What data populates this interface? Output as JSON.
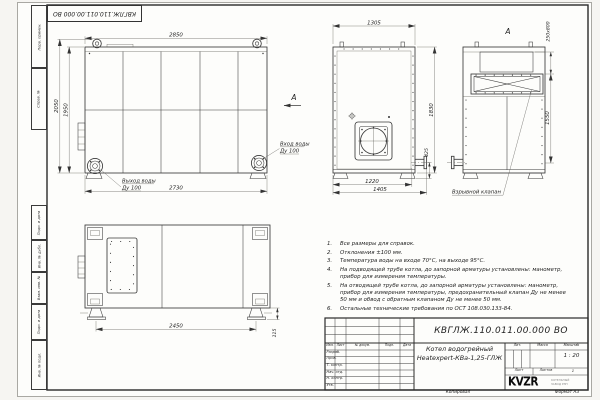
{
  "sheet": {
    "stamp_top": "КВГЛЖ.110.011.00.000 ВО",
    "side_labels": [
      "Перв. примен.",
      "Справ. №",
      "Подп. и дата",
      "Инв. № дубл.",
      "Взам. инв. №",
      "Подп. и дата",
      "Инв. № подл."
    ],
    "footer": {
      "copied": "Копировал",
      "format": "Формат А3"
    },
    "colors": {
      "line": "#3a3a3a",
      "paper": "#fdfdfb"
    }
  },
  "views": {
    "front": {
      "dim_width_top": "2850",
      "dim_height_outer": "2050",
      "dim_height_inner": "1950",
      "dim_width_bottom": "2730",
      "outlet_label": "Выход воды",
      "outlet_size": "Ду 100",
      "inlet_label": "Вход воды",
      "inlet_size": "Ду 100",
      "section_arrow": "А"
    },
    "side": {
      "dim_width_top": "1305",
      "dim_height": "1830",
      "dim_width_bottom_inner": "1220",
      "dim_width_bottom_outer": "1405",
      "dim_pipe": "425"
    },
    "view_a": {
      "label": "А",
      "dim_valve": "250x800",
      "dim_height": "1550",
      "callout": "Взрывной клапан"
    },
    "plan": {
      "dim_width": "2450",
      "dim_foot": "115"
    }
  },
  "notes": [
    {
      "num": "1.",
      "text": "Все размеры для справок."
    },
    {
      "num": "2.",
      "text": "Отклонения ±100 мм."
    },
    {
      "num": "3.",
      "text": "Температура воды на входе 70°С, на выходе 95°С."
    },
    {
      "num": "4.",
      "text": "На подводящей трубе котла, до запорной арматуры установлены: манометр, прибор для измерения температуры."
    },
    {
      "num": "5.",
      "text": "На отводящей трубе котла, до запорной арматуры установлены: манометр, прибор для измерения температуры, предохранительный клапан Ду не менее 50 мм и обвод с обратным клапаном Ду не менее 50 мм."
    },
    {
      "num": "6.",
      "text": "Остальные технические требования по ОСТ 108.030.133-84."
    }
  ],
  "title_block": {
    "doc_number": "КВГЛЖ.110.011.00.000 ВО",
    "product_name_1": "Котел водогрейный",
    "product_name_2": "Heatexpert-КВа-1,25-ГЛЖ",
    "cols": [
      "Изм.",
      "Лист",
      "№ докум.",
      "Подп.",
      "Дата"
    ],
    "rows": [
      "Разраб.",
      "Пров.",
      "Т. контр.",
      "Нач. отд.",
      "Н. контр.",
      "Утв."
    ],
    "lit_label": "Лит.",
    "mass_label": "Масса",
    "scale_label": "Масштаб",
    "scale_value": "1 : 20",
    "sheet_label": "Лист",
    "sheets_label": "Листов",
    "sheets_value": "1",
    "logo": "KVZR",
    "logo_sub_1": "КОТЕЛЬНЫЙ",
    "logo_sub_2": "ЗАВОД РЭП"
  }
}
